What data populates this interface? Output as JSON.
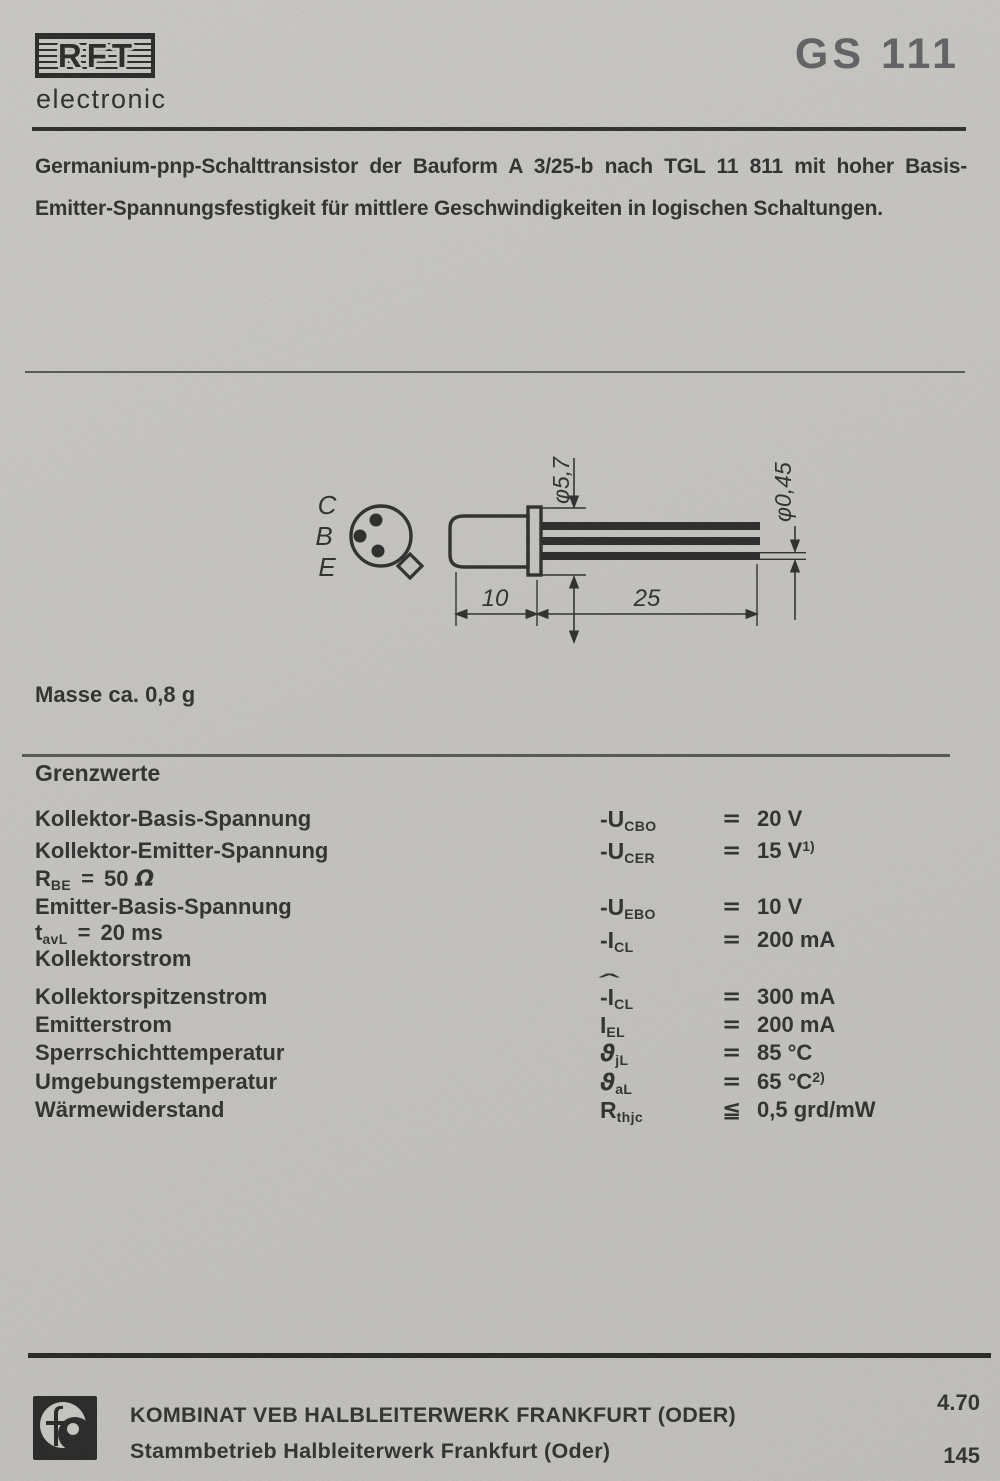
{
  "header": {
    "brand": "RFT",
    "brand_sub": "electronic",
    "product_code": "GS 111"
  },
  "description": {
    "line1": "Germanium-pnp-Schalttransistor der Bauform A 3/25-b nach TGL 11 811 mit hoher Basis-",
    "line2": "Emitter-Spannungsfestigkeit für mittlere Geschwindigkeiten in logischen Schaltungen."
  },
  "drawing": {
    "pin_labels": [
      "C",
      "B",
      "E"
    ],
    "dims": {
      "body_diameter": "φ5,7",
      "lead_diameter": "φ0,45",
      "body_length": "10",
      "lead_length": "25"
    }
  },
  "mass_note": "Masse ca. 0,8 g",
  "limits": {
    "heading": "Grenzwerte",
    "rows": [
      {
        "label": "Kollektor-Basis-Spannung",
        "sym_pre": "-U",
        "sym_sub": "CBO",
        "rel": "=",
        "val": "20 V"
      },
      {
        "label": "Kollektor-Emitter-Spannung",
        "sym_pre": "-U",
        "sym_sub": "CER",
        "rel": "=",
        "val": "15 V",
        "val_sup": "1)"
      },
      {
        "label_pre": "R",
        "label_sub": "BE",
        "label_eq": "=",
        "label_num": "50",
        "label_om": "Ω"
      },
      {
        "label": "Emitter-Basis-Spannung",
        "sym_pre": "-U",
        "sym_sub": "EBO",
        "rel": "=",
        "val": "10 V"
      },
      {
        "label_pre": "t",
        "label_sub": "avL",
        "label_eq": "=",
        "label_num": "20 ms",
        "sym_pre": "-I",
        "sym_sub": "CL",
        "rel": "=",
        "val": "200 mA"
      },
      {
        "label": "Kollektorstrom"
      },
      {
        "label": "Kollektorspitzenstrom",
        "sym_hat": "ˆ",
        "sym_pre": "-I",
        "sym_sub": "CL",
        "rel": "=",
        "val": "300 mA"
      },
      {
        "label": "Emitterstrom",
        "sym_pre": "I",
        "sym_sub": "EL",
        "rel": "=",
        "val": "200 mA"
      },
      {
        "label": "Sperrschichttemperatur",
        "sym_pre": "ϑ",
        "sym_sub": "jL",
        "rel": "=",
        "val": "85 °C"
      },
      {
        "label": "Umgebungstemperatur",
        "sym_pre": "ϑ",
        "sym_sub": "aL",
        "rel": "=",
        "val": "65 °C",
        "val_sup": "2)"
      },
      {
        "label": "Wärmewiderstand",
        "sym_pre": "R",
        "sym_sub": "thjc",
        "rel": "≦",
        "val": "0,5 grd/mW"
      }
    ]
  },
  "footer": {
    "line1": "KOMBINAT VEB HALBLEITERWERK FRANKFURT (ODER)",
    "line2": "Stammbetrieb Halbleiterwerk Frankfurt (Oder)",
    "date_code": "4.70",
    "page_number": "145"
  }
}
